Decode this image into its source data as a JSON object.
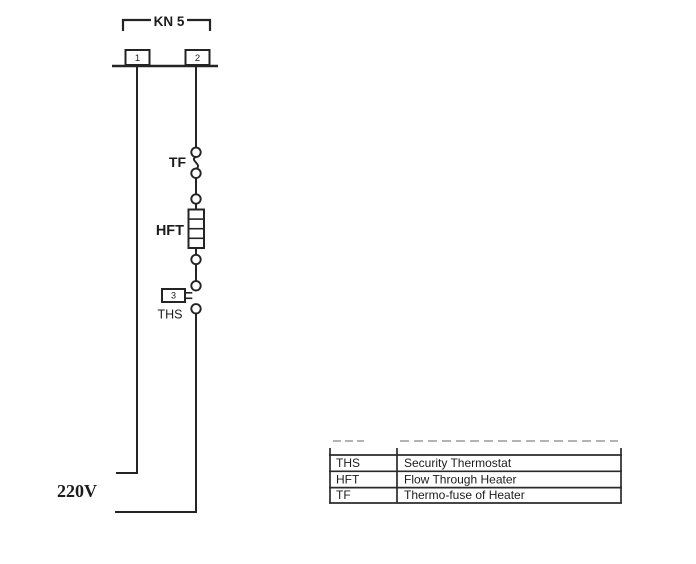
{
  "connector": {
    "label": "KN 5",
    "pin1": "1",
    "pin2": "2"
  },
  "components": {
    "tf_label": "TF",
    "hft_label": "HFT",
    "ths_label": "THS",
    "ths_terminal": "3"
  },
  "supply": {
    "voltage": "220V"
  },
  "legend": {
    "rows": [
      {
        "code": "THS",
        "description": "Security Thermostat"
      },
      {
        "code": "HFT",
        "description": "Flow Through Heater"
      },
      {
        "code": "TF",
        "description": "Thermo-fuse of Heater"
      }
    ]
  },
  "colors": {
    "line": "#242424",
    "faded_row": "#b3b3b3",
    "background": "#ffffff"
  }
}
